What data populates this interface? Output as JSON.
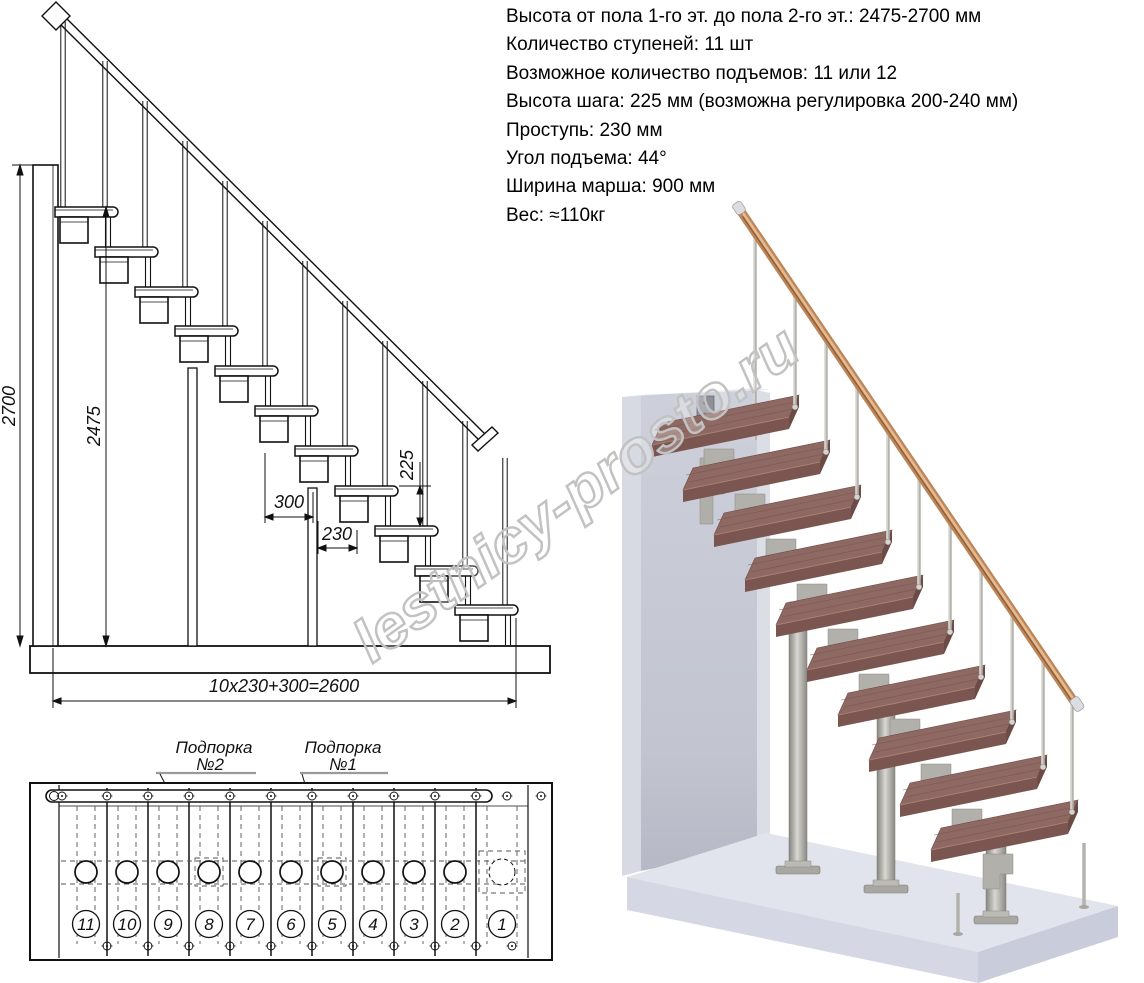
{
  "specs": {
    "lines": [
      "Высота от пола 1-го эт. до пола 2-го эт.: 2475-2700 мм",
      "Количество ступеней: 11 шт",
      "Возможное количество подъемов: 11 или 12",
      "Высота шага: 225 мм (возможна регулировка 200-240 мм)",
      "Проступь: 230 мм",
      "Угол подъема: 44°",
      "Ширина марша: 900 мм",
      "Вес: ≈110кг"
    ]
  },
  "side_view": {
    "dims": {
      "total_height": "2700",
      "clear_height": "2475",
      "going_top": "300",
      "going": "230",
      "riser": "225",
      "length_formula": "10x230+300=2600"
    }
  },
  "plan_view": {
    "support2_line1": "Подпорка",
    "support2_line2": "№2",
    "support1_line1": "Подпорка",
    "support1_line2": "№1",
    "step_numbers": [
      "11",
      "10",
      "9",
      "8",
      "7",
      "6",
      "5",
      "4",
      "3",
      "2",
      "1"
    ]
  },
  "watermark": {
    "text": "lestnicy-prosto.ru"
  },
  "colors": {
    "line": "#111111",
    "wood_tread": "#8e6862",
    "wood_rail": "#bd8659",
    "metal": "#b2b0aa",
    "wall": "#c4c7d2",
    "floor": "#e1e3ed",
    "watermark": "#c2c2c2"
  }
}
